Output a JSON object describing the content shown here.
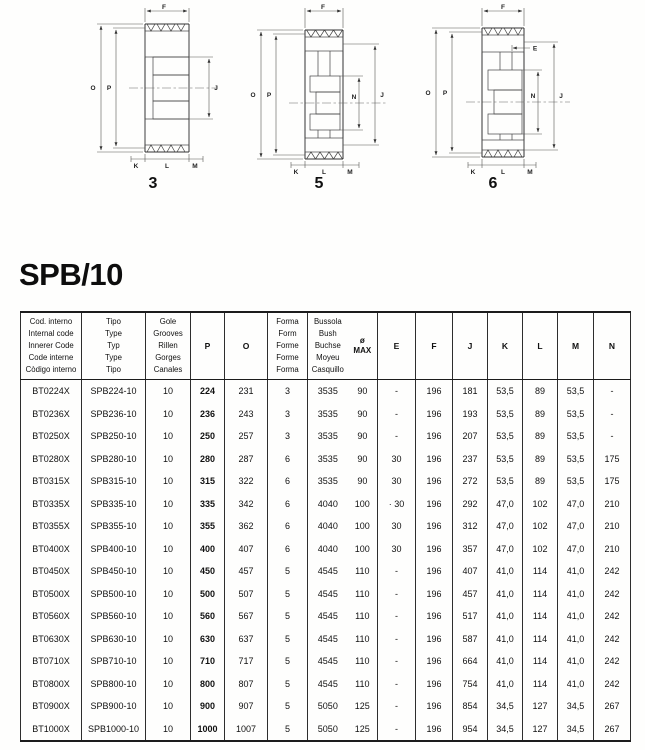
{
  "page": {
    "title": "SPB/10"
  },
  "diagrams": {
    "form3": {
      "number": "3",
      "labels": {
        "F": "F",
        "O": "O",
        "P": "P",
        "J": "J",
        "K": "K",
        "L": "L",
        "M": "M"
      }
    },
    "form5": {
      "number": "5",
      "labels": {
        "F": "F",
        "O": "O",
        "P": "P",
        "N": "N",
        "J": "J",
        "K": "K",
        "L": "L",
        "M": "M"
      }
    },
    "form6": {
      "number": "6",
      "labels": {
        "F": "F",
        "E": "E",
        "O": "O",
        "P": "P",
        "N": "N",
        "J": "J",
        "K": "K",
        "L": "L",
        "M": "M"
      }
    }
  },
  "table": {
    "headers": {
      "code": [
        "Cod. interno",
        "Internal code",
        "Innerer Code",
        "Code interne",
        "Còdigo interno"
      ],
      "type": [
        "Tipo",
        "Type",
        "Typ",
        "Type",
        "Tipo"
      ],
      "grooves": [
        "Gole",
        "Grooves",
        "Rillen",
        "Gorges",
        "Canales"
      ],
      "p": "P",
      "o": "O",
      "form": [
        "Forma",
        "Form",
        "Forme",
        "Forme",
        "Forma"
      ],
      "bush": [
        "Bussola",
        "Bush",
        "Buchse",
        "Moyeu",
        "Casquillo"
      ],
      "diamax": [
        "ø",
        "MAX"
      ],
      "e": "E",
      "f": "F",
      "j": "J",
      "k": "K",
      "l": "L",
      "m": "M",
      "n": "N"
    },
    "rows": [
      [
        "BT0224X",
        "SPB224-10",
        "10",
        "224",
        "231",
        "3",
        "3535",
        "90",
        "-",
        "196",
        "181",
        "53,5",
        "89",
        "53,5",
        "-"
      ],
      [
        "BT0236X",
        "SPB236-10",
        "10",
        "236",
        "243",
        "3",
        "3535",
        "90",
        "-",
        "196",
        "193",
        "53,5",
        "89",
        "53,5",
        "-"
      ],
      [
        "BT0250X",
        "SPB250-10",
        "10",
        "250",
        "257",
        "3",
        "3535",
        "90",
        "-",
        "196",
        "207",
        "53,5",
        "89",
        "53,5",
        "-"
      ],
      [
        "BT0280X",
        "SPB280-10",
        "10",
        "280",
        "287",
        "6",
        "3535",
        "90",
        "30",
        "196",
        "237",
        "53,5",
        "89",
        "53,5",
        "175"
      ],
      [
        "BT0315X",
        "SPB315-10",
        "10",
        "315",
        "322",
        "6",
        "3535",
        "90",
        "30",
        "196",
        "272",
        "53,5",
        "89",
        "53,5",
        "175"
      ],
      [
        "BT0335X",
        "SPB335-10",
        "10",
        "335",
        "342",
        "6",
        "4040",
        "100",
        "· 30",
        "196",
        "292",
        "47,0",
        "102",
        "47,0",
        "210"
      ],
      [
        "BT0355X",
        "SPB355-10",
        "10",
        "355",
        "362",
        "6",
        "4040",
        "100",
        "30",
        "196",
        "312",
        "47,0",
        "102",
        "47,0",
        "210"
      ],
      [
        "BT0400X",
        "SPB400-10",
        "10",
        "400",
        "407",
        "6",
        "4040",
        "100",
        "30",
        "196",
        "357",
        "47,0",
        "102",
        "47,0",
        "210"
      ],
      [
        "BT0450X",
        "SPB450-10",
        "10",
        "450",
        "457",
        "5",
        "4545",
        "110",
        "-",
        "196",
        "407",
        "41,0",
        "114",
        "41,0",
        "242"
      ],
      [
        "BT0500X",
        "SPB500-10",
        "10",
        "500",
        "507",
        "5",
        "4545",
        "110",
        "-",
        "196",
        "457",
        "41,0",
        "114",
        "41,0",
        "242"
      ],
      [
        "BT0560X",
        "SPB560-10",
        "10",
        "560",
        "567",
        "5",
        "4545",
        "110",
        "-",
        "196",
        "517",
        "41,0",
        "114",
        "41,0",
        "242"
      ],
      [
        "BT0630X",
        "SPB630-10",
        "10",
        "630",
        "637",
        "5",
        "4545",
        "110",
        "-",
        "196",
        "587",
        "41,0",
        "114",
        "41,0",
        "242"
      ],
      [
        "BT0710X",
        "SPB710-10",
        "10",
        "710",
        "717",
        "5",
        "4545",
        "110",
        "-",
        "196",
        "664",
        "41,0",
        "114",
        "41,0",
        "242"
      ],
      [
        "BT0800X",
        "SPB800-10",
        "10",
        "800",
        "807",
        "5",
        "4545",
        "110",
        "-",
        "196",
        "754",
        "41,0",
        "114",
        "41,0",
        "242"
      ],
      [
        "BT0900X",
        "SPB900-10",
        "10",
        "900",
        "907",
        "5",
        "5050",
        "125",
        "-",
        "196",
        "854",
        "34,5",
        "127",
        "34,5",
        "267"
      ],
      [
        "BT1000X",
        "SPB1000-10",
        "10",
        "1000",
        "1007",
        "5",
        "5050",
        "125",
        "-",
        "196",
        "954",
        "34,5",
        "127",
        "34,5",
        "267"
      ]
    ]
  }
}
